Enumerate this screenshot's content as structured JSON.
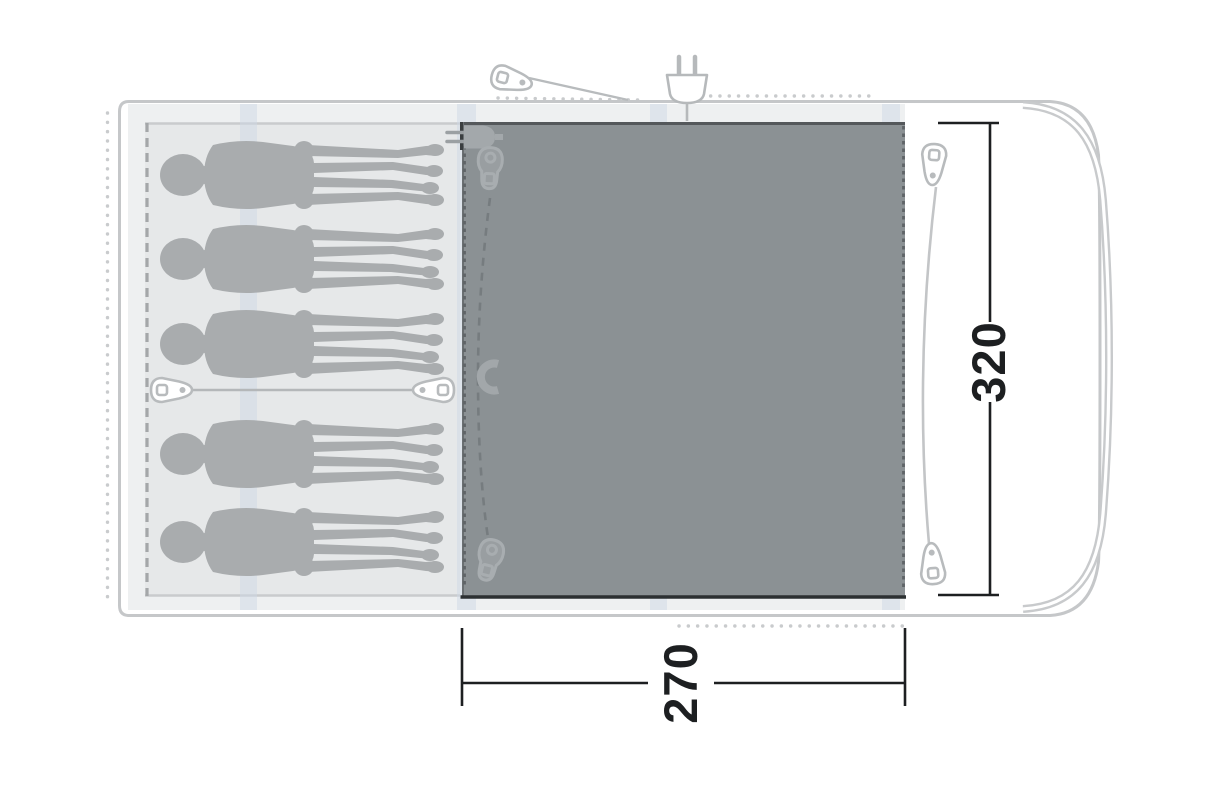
{
  "diagram": {
    "type": "tent floorplan (top view)",
    "dimension_labels": {
      "depth": "320",
      "width": "270"
    },
    "sleeping_capacity": 5,
    "areas": {
      "sleeping_cabin": "left area with 5 person silhouettes",
      "living_area": "dark shaded canopy area 270 x 320",
      "porch": "right open area with curved front wall"
    },
    "icons": [
      "power-plug",
      "cable-entry-plug",
      "zipper-pull",
      "toggle",
      "guy-line-peg",
      "magnet"
    ],
    "colors": {
      "living_area": "#8b9194",
      "sleeping_cabin": "#e6e8e9",
      "floor": "#eef0f1",
      "person": "#a9acae",
      "pole_band": "#cdd7e6",
      "tent_outline": "#c5c7c9",
      "dimension_line": "#1d1f21",
      "dotted_guyline": "#c9cbcd"
    }
  }
}
